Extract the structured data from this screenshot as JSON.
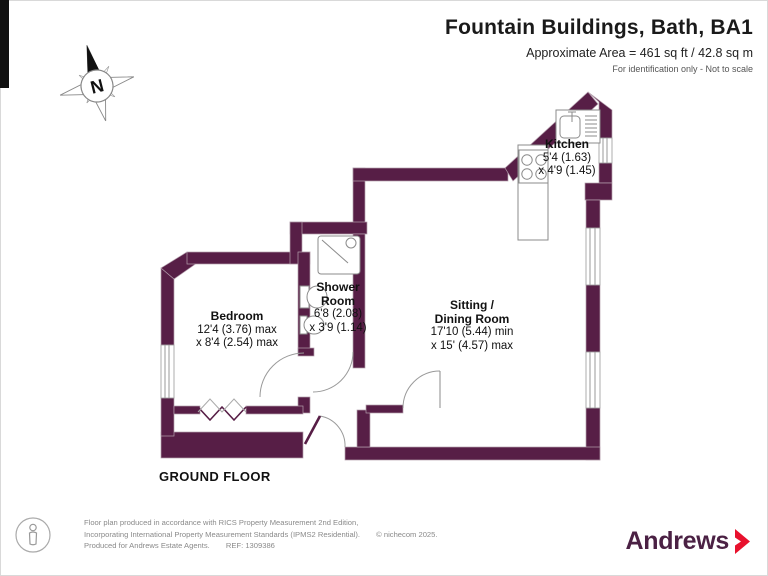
{
  "header": {
    "title": "Fountain Buildings, Bath, BA1",
    "area": "Approximate Area = 461 sq ft / 42.8 sq m",
    "note": "For identification only - Not to scale"
  },
  "compass": {
    "north_label": "N"
  },
  "rooms": {
    "kitchen": {
      "name": "Kitchen",
      "dim1": "5'4 (1.63)",
      "dim2": "x 4'9 (1.45)"
    },
    "shower": {
      "name_line1": "Shower",
      "name_line2": "Room",
      "dim1": "6'8 (2.08)",
      "dim2": "x 3'9 (1.14)"
    },
    "bedroom": {
      "name": "Bedroom",
      "dim1": "12'4 (3.76) max",
      "dim2": "x 8'4 (2.54) max"
    },
    "sitting": {
      "name_line1": "Sitting /",
      "name_line2": "Dining Room",
      "dim1": "17'10 (5.44) min",
      "dim2": "x 15' (4.57) max"
    }
  },
  "floor_label": "GROUND FLOOR",
  "footer": {
    "line1": "Floor plan produced in accordance with RICS Property Measurement 2nd Edition,",
    "line2": "Incorporating International Property Measurement Standards (IPMS2 Residential).",
    "line2b": "© nichecom 2025.",
    "line3": "Produced for Andrews Estate Agents.",
    "line3b": "REF: 1309386"
  },
  "logo": {
    "name": "Andrews"
  },
  "colors": {
    "wall": "#571E46",
    "brand_purple": "#4B2144",
    "brand_red": "#E8112D"
  }
}
